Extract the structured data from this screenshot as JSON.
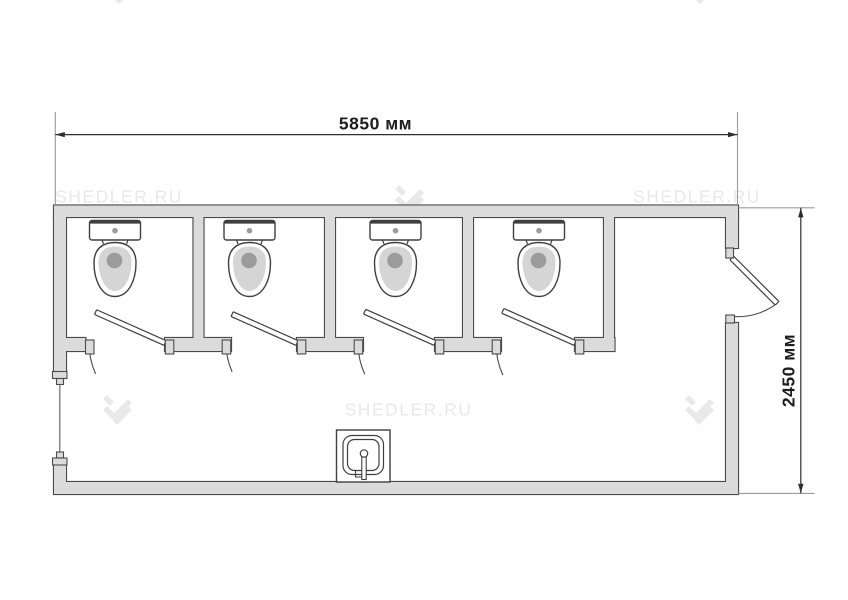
{
  "page": {
    "background_color": "#ffffff"
  },
  "drawing": {
    "type": "floor-plan",
    "subject": "sanitary container module, top view",
    "stall_count": 4,
    "fixtures": {
      "toilets": 4,
      "washbasins": 1,
      "stall_doors": 4,
      "entrance_doors": 1,
      "windows": 1
    }
  },
  "dimensions": {
    "width_label": "5850 мм",
    "height_label": "2450 мм"
  },
  "watermark": {
    "text": "SHEDLER.RU",
    "color": "#e9e9e9"
  },
  "colors": {
    "wall_fill": "#dbdbdb",
    "wall_outline": "#4a4a4a",
    "fixture_outline": "#3f3f3f",
    "fixture_fill": "#d5d5d5",
    "accent_dot": "#9b9b9b",
    "dimension_line": "#2e2e2e",
    "extension_line": "#9a9a9a",
    "dimension_text": "#1d1d1d"
  }
}
